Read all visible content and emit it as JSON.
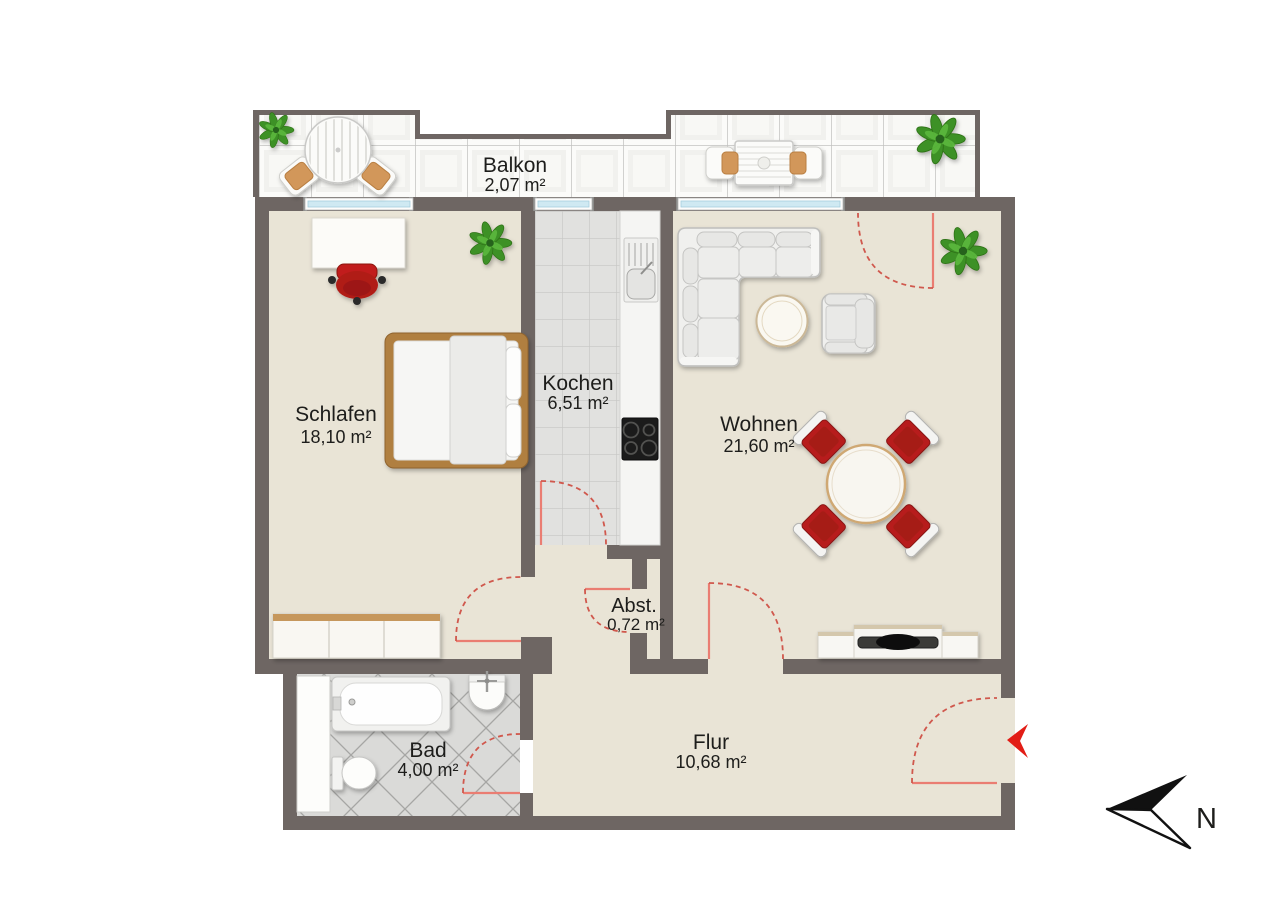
{
  "rooms": [
    {
      "id": "balkon",
      "name": "Balkon",
      "area": "2,07 m²"
    },
    {
      "id": "schlafen",
      "name": "Schlafen",
      "area": "18,10 m²"
    },
    {
      "id": "kochen",
      "name": "Kochen",
      "area": "6,51 m²"
    },
    {
      "id": "wohnen",
      "name": "Wohnen",
      "area": "21,60 m²"
    },
    {
      "id": "abstellraum",
      "name": "Abst.",
      "area": "0,72 m²"
    },
    {
      "id": "bad",
      "name": "Bad",
      "area": "4,00 m²"
    },
    {
      "id": "flur",
      "name": "Flur",
      "area": "10,68 m²"
    }
  ],
  "compass": {
    "label": "N"
  },
  "icons": {
    "north_arrow": "north-arrow-icon",
    "entrance_arrow": "entrance-arrow-icon"
  },
  "colors": {
    "wall": "#6e6663",
    "floor": "#e9e4d6",
    "balcony_tile": "#fbfbf9",
    "kitchen_tile": "#e1e1df",
    "bath_tile": "#dadad8",
    "door_swing_red": "#d0584d",
    "furniture_red": "#b71f1c",
    "wood": "#b07f41",
    "plant_green": "#3e9127",
    "window_glass": "#cfe9f2"
  }
}
